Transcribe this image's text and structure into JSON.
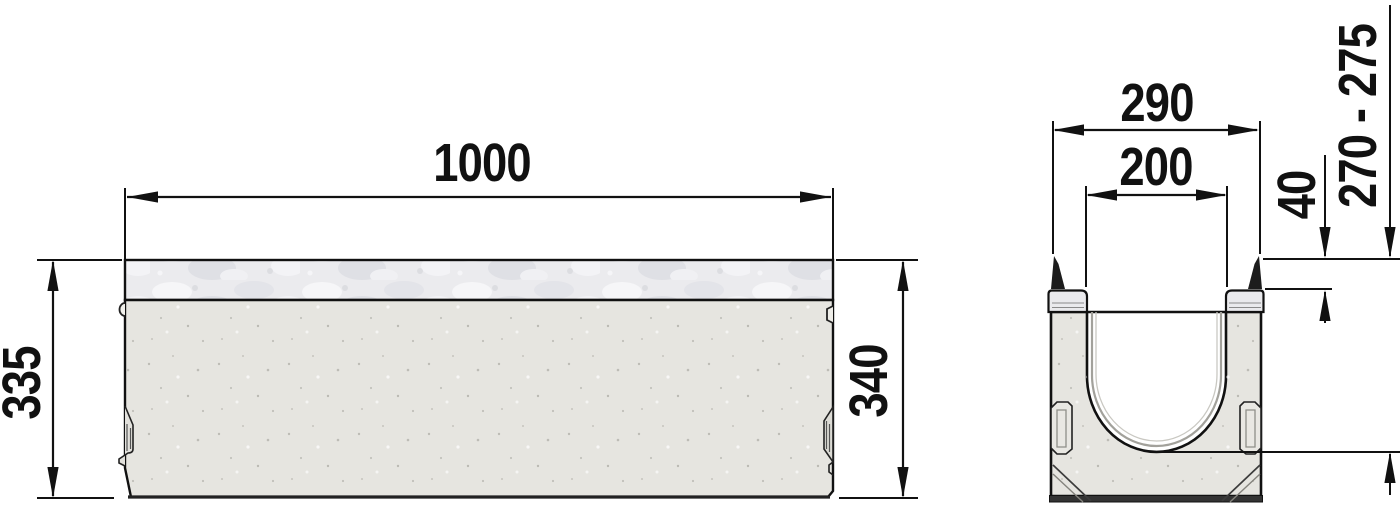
{
  "side_view": {
    "dims": {
      "length": "1000",
      "height_left": "335",
      "height_right": "340"
    }
  },
  "cross_section": {
    "dims": {
      "outer_width": "290",
      "inner_width": "200",
      "edge_depth": "40",
      "height_range": "270 - 275"
    }
  },
  "colors": {
    "line": "#111111",
    "concrete": "#e6e5e0",
    "galvanized": "#ebebee",
    "background": "#ffffff"
  }
}
